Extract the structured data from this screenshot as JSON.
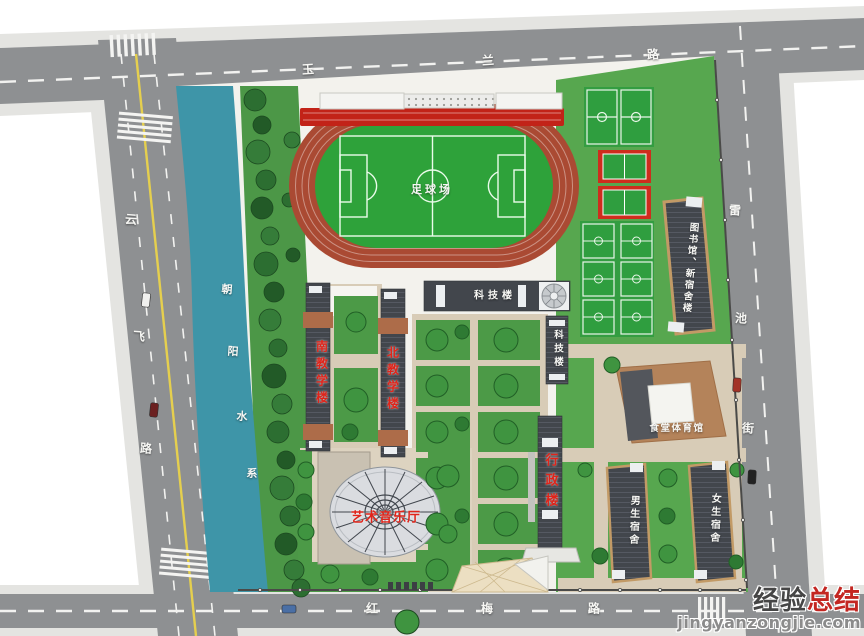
{
  "map": {
    "roads": {
      "top": {
        "name": "玉兰路",
        "chars": [
          "玉",
          "兰",
          "路"
        ]
      },
      "left": {
        "name": "云飞路",
        "chars": [
          "云",
          "飞",
          "路"
        ]
      },
      "right": {
        "name": "雷池街",
        "chars": [
          "雷",
          "池",
          "街"
        ]
      },
      "bottom": {
        "name": "红梅路",
        "chars": [
          "红",
          "梅",
          "路"
        ]
      }
    },
    "water": {
      "name": "朝阳水系",
      "chars": [
        "朝",
        "阳",
        "水",
        "系"
      ]
    },
    "places": {
      "football_field": "足球场",
      "science_building": "科技楼",
      "science_building_wing": "科技楼",
      "south_teaching": "南教学楼",
      "north_teaching": "北教学楼",
      "admin": "行政楼",
      "art_music_hall": "艺术音乐厅",
      "canteen_gym": "食堂体育馆",
      "library_new_dorm": "图书馆、新宿舍楼",
      "boys_dorm": "男生宿舍",
      "girls_dorm": "女生宿舍"
    }
  },
  "colors": {
    "road": "#8e9092",
    "water": "#3e95a8",
    "lawn": "#57a74f",
    "track_red": "#aa4a33",
    "field_green": "#2ea23a",
    "stand_red": "#c22318",
    "label_red": "#e0241a",
    "building_dark": "#42464c",
    "wm_red": "#c32621",
    "wm_gray": "#8b8b8b"
  },
  "watermark": {
    "brand_dark": "经验",
    "brand_red": "总结",
    "site": "jingyanzongjie.com"
  }
}
